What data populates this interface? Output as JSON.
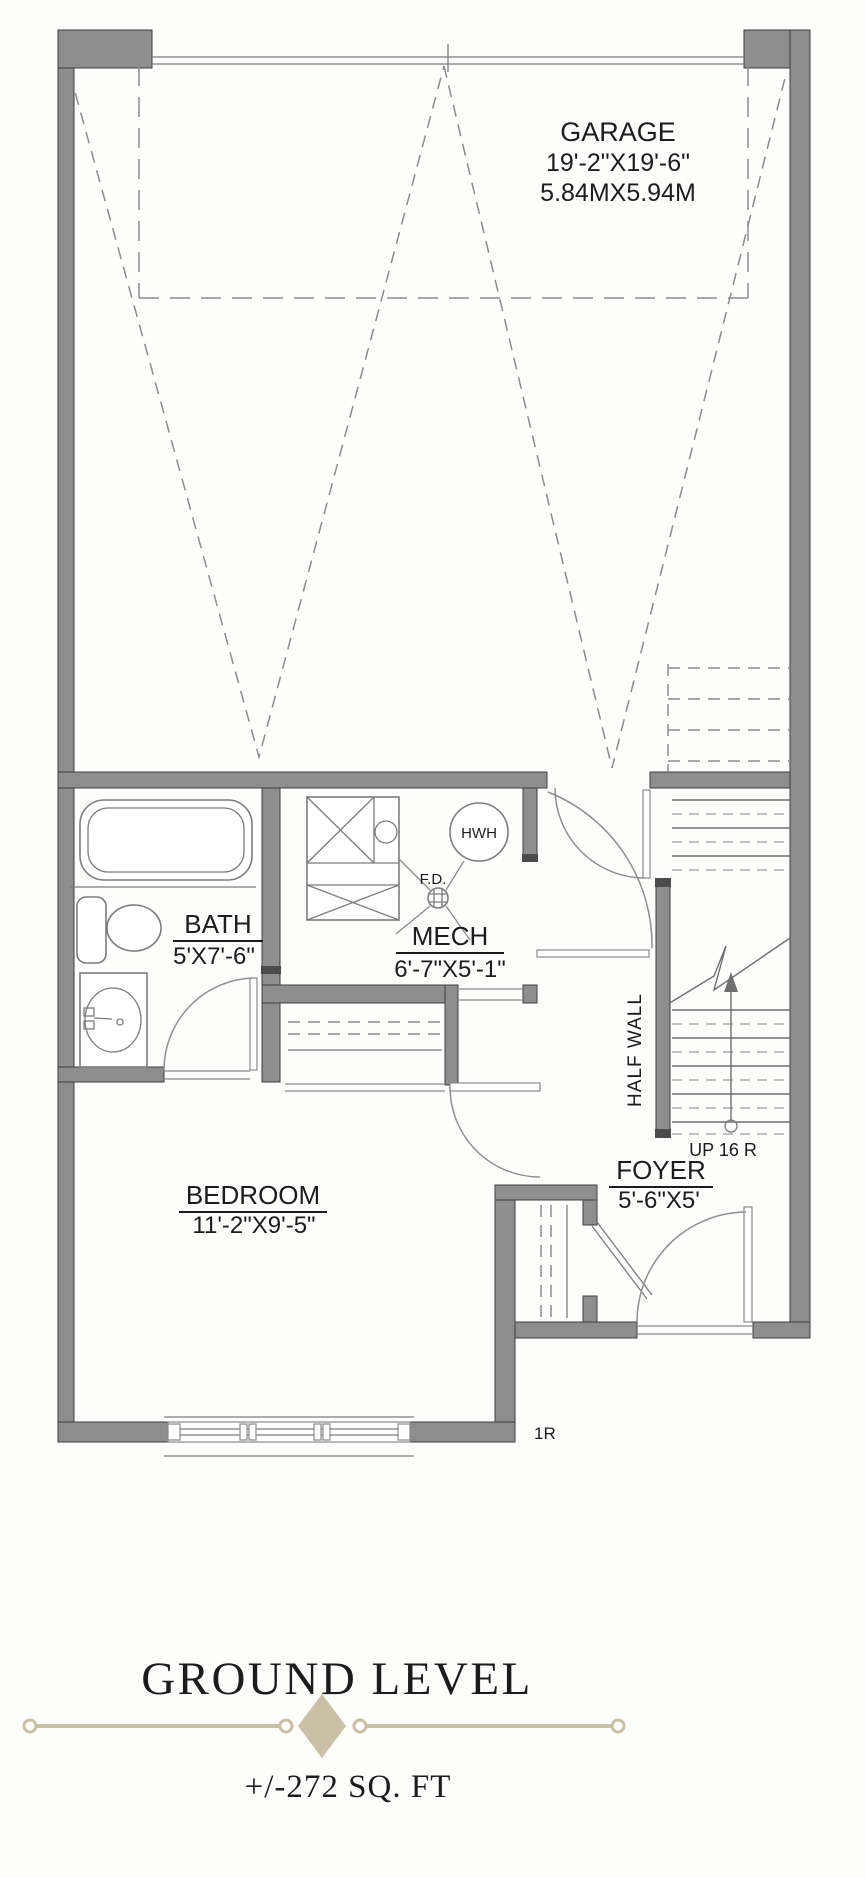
{
  "plan": {
    "garage": {
      "name": "GARAGE",
      "dim_ft": "19'-2\"X19'-6\"",
      "dim_m": "5.84MX5.94M"
    },
    "bath": {
      "name": "BATH",
      "dim": "5'X7'-6\""
    },
    "mech": {
      "name": "MECH",
      "dim": "6'-7\"X5'-1\""
    },
    "bedroom": {
      "name": "BEDROOM",
      "dim": "11'-2\"X9'-5\""
    },
    "foyer": {
      "name": "FOYER",
      "dim": "5'-6\"X5'"
    },
    "labels": {
      "water_heater": "HWH",
      "floor_drain": "F.D.",
      "half_wall": "HALF WALL",
      "stairs_up": "UP 16 R",
      "one_riser": "1R"
    }
  },
  "title": {
    "heading": "GROUND LEVEL",
    "area": "+/-272 SQ. FT"
  },
  "colors": {
    "wall": "#8e8e8e",
    "divider": "#c9c0a6",
    "text": "#1c1c1c"
  }
}
